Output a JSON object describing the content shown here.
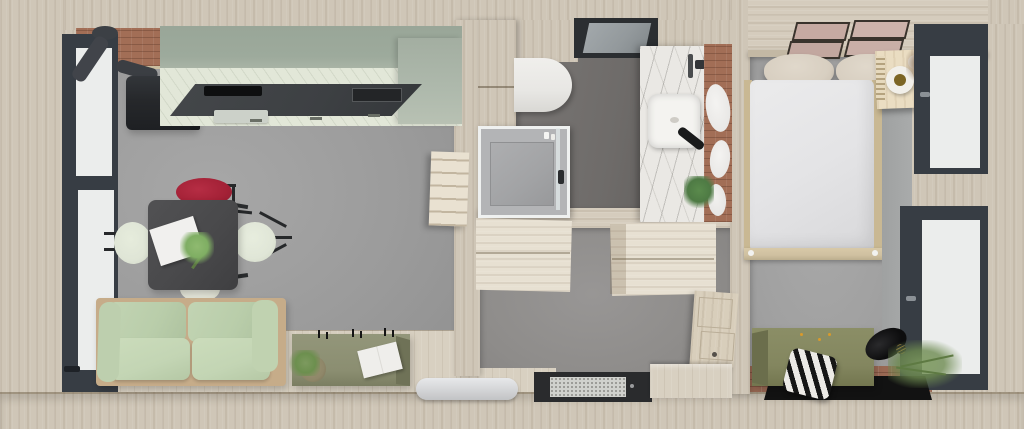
{
  "scene": {
    "label": "Top-down 3D interior render of a tiny house floor plan",
    "rooms": {
      "living": {
        "label": "Living room with kitchen and dining area"
      },
      "bathroom": {
        "label": "Bathroom"
      },
      "hall": {
        "label": "Entry hall with built-in wardrobes"
      },
      "bedroom": {
        "label": "Bedroom"
      }
    }
  },
  "palette": {
    "exterior_wood": "#cfc6b7",
    "interior_wood": "#ddd4c3",
    "plank_floor": "#d8d0c1",
    "concrete_floor": "#9b9b9b",
    "bathroom_floor": "#6e6b69",
    "terracotta_floor": "#996853",
    "kitchen_sage": "#9daa9c",
    "kitchen_front": "#e2e7d8",
    "countertop_dark": "#3d4043",
    "sofa_green": "#bdd0ac",
    "chair_red": "#a32136",
    "olive_furniture": "#878a6c",
    "brick": "#a26e56",
    "marble": "#eae8e4",
    "window_frame": "#373d44",
    "duvet_white": "#e4e4e6"
  },
  "furniture": {
    "window_west": "Full-height window with dark frame (west wall)",
    "brick_chimney_wall": "Exposed brick chimney wall",
    "stove_flue": "Stove flue pipe",
    "wood_stove": "Black wood-burning stove",
    "kitchen_upper": "Sage green kitchen tall cabinets",
    "kitchen_front": "Kitchen base cabinets",
    "countertop": "Dark kitchen countertop",
    "cooktop": "Built-in cooktop",
    "kitchen_drawer": "Kitchen drawer front",
    "dining_table": "Dark square dining table",
    "notebook": "Open notebook on table",
    "bouquet": "Green bouquet centerpiece",
    "chair_red": "Red shell chair",
    "chair_west": "Pale green shell chair (west)",
    "chair_east": "Pale green shell chair (east)",
    "chair_south": "Pale green shell chair (south)",
    "sofa": "Sage green sofa with wooden frame",
    "sideboard": "Olive sideboard",
    "candles": "Candles on sideboard",
    "open_book": "Open book on sideboard",
    "basket_plant": "Potted trailing plant in basket",
    "ladder": "Wooden loft ladder against partition wall",
    "radiator": "White radiator at entry",
    "plank_floor": "Wood plank floor strip",
    "bath_cabinet": "Wooden bathroom cabinet column",
    "toilet": "Wall-hung toilet",
    "skylight": "Roof window above bathroom",
    "shower": "Walk-in shower with glass screen",
    "vanity": "Marble washbasin counter",
    "basin": "Square countertop basin",
    "tap": "Black basin tap",
    "mirror_wall": "Brick wall with oval mirrors",
    "bath_plant": "Potted plant on vanity",
    "wardrobe_north": "Built-in wardrobe (top view)",
    "wardrobe_east": "Built-in wardrobe (top view)",
    "hall_cabinet": "Wooden hallway cabinet",
    "entry_door": "Entry door with glass panel",
    "door_mat": "Speckled doormat",
    "entry_step": "Wooden entry step",
    "headboard_shelf": "Headboard shelf with four framed prints",
    "picture_frame": "Framed print",
    "pillow": "Bed pillow",
    "bed": "Double bed with white duvet",
    "bed_foot": "Wooden bed foot bench",
    "nightstand": "Wooden nightstand",
    "tray": "Round tray on nightstand",
    "pampas": "Dried pampas grass",
    "window_north_east": "Bedroom window (north-east)",
    "window_south_east": "Bedroom window (south-east)",
    "ottoman": "Olive blanket box at foot of bed",
    "striped_cushion": "Black-and-white striped cushion",
    "rug_black": "Black rug",
    "vase_black": "Black round vase",
    "trailing_plant": "Trailing green plant",
    "terracotta": "Terracotta tile floor strip"
  }
}
